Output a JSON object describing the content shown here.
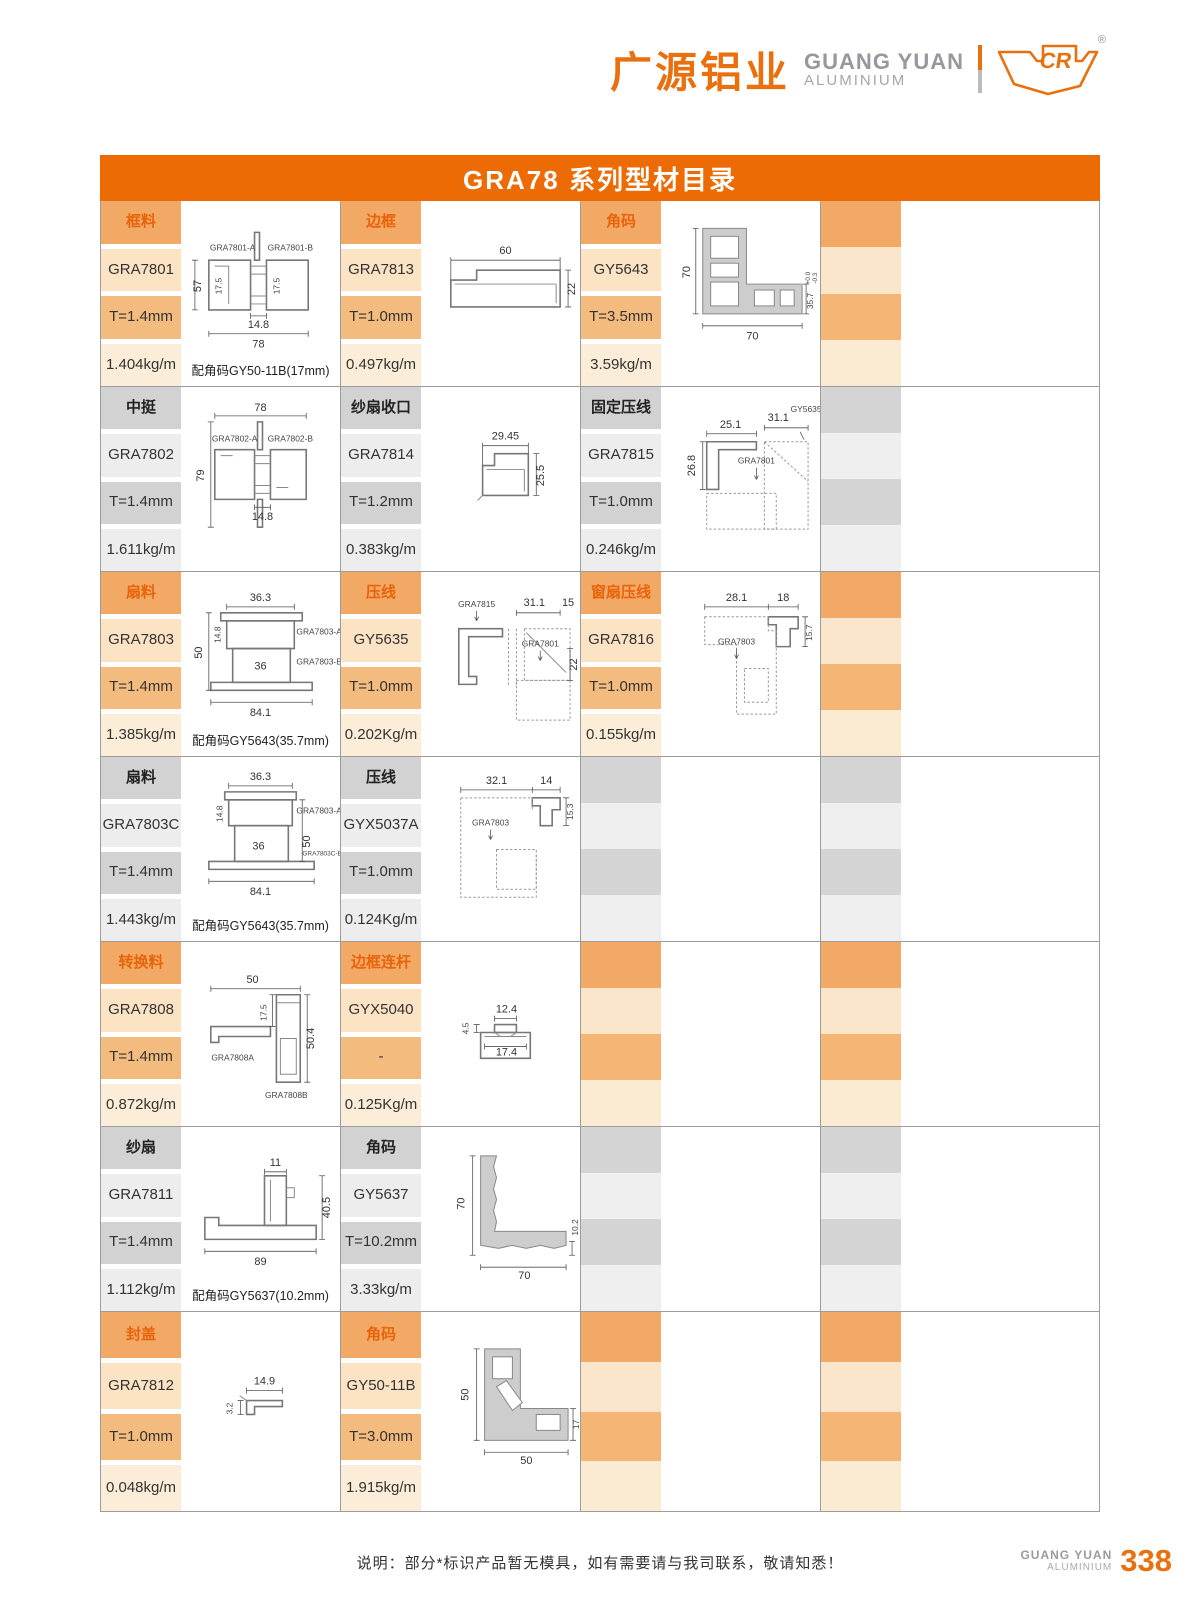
{
  "header": {
    "brand_cn": "广源铝业",
    "brand_en1": "GUANG YUAN",
    "brand_en2": "ALUMINIUM",
    "logo_mark": "CR",
    "registered": "®"
  },
  "title": "GRA78 系列型材目录",
  "colors": {
    "title_bar": "#EC6B05",
    "orange_dark": "#F2A965",
    "orange_light": "#FBE3C4",
    "orange_label_text": "#E8630A",
    "gray_dark": "#D2D2D2",
    "gray_light": "#EDEDED",
    "brand_orange": "#E8700F"
  },
  "rows": [
    {
      "tone": "orange",
      "groups": [
        {
          "label": "框料",
          "code": "GRA7801",
          "thickness": "T=1.4mm",
          "weight": "1.404kg/m",
          "note": "配角码GY50-11B(17mm)",
          "dims": [
            "57",
            "17.5",
            "17.5",
            "14.8",
            "78"
          ],
          "marks": [
            "GRA7801-A",
            "GRA7801-B"
          ]
        },
        {
          "label": "边框",
          "code": "GRA7813",
          "thickness": "T=1.0mm",
          "weight": "0.497kg/m",
          "dims": [
            "60",
            "22"
          ]
        },
        {
          "label": "角码",
          "code": "GY5643",
          "thickness": "T=3.5mm",
          "weight": "3.59kg/m",
          "dims": [
            "70",
            "70",
            "35.7",
            "+0.0",
            "-0.3"
          ]
        }
      ]
    },
    {
      "tone": "gray",
      "groups": [
        {
          "label": "中挺",
          "code": "GRA7802",
          "thickness": "T=1.4mm",
          "weight": "1.611kg/m",
          "dims": [
            "78",
            "79",
            "14.8"
          ],
          "marks": [
            "GRA7802-A",
            "GRA7802-B"
          ]
        },
        {
          "label": "纱扇收口",
          "code": "GRA7814",
          "thickness": "T=1.2mm",
          "weight": "0.383kg/m",
          "dims": [
            "29.45",
            "25.5"
          ]
        },
        {
          "label": "固定压线",
          "code": "GRA7815",
          "thickness": "T=1.0mm",
          "weight": "0.246kg/m",
          "dims": [
            "25.1",
            "26.8",
            "31.1"
          ],
          "marks": [
            "GY5635",
            "GRA7801"
          ]
        }
      ]
    },
    {
      "tone": "orange",
      "groups": [
        {
          "label": "扇料",
          "code": "GRA7803",
          "thickness": "T=1.4mm",
          "weight": "1.385kg/m",
          "note": "配角码GY5643(35.7mm)",
          "dims": [
            "36.3",
            "14.8",
            "50",
            "36",
            "84.1"
          ],
          "marks": [
            "GRA7803-A",
            "GRA7803-B"
          ]
        },
        {
          "label": "压线",
          "code": "GY5635",
          "thickness": "T=1.0mm",
          "weight": "0.202Kg/m",
          "dims": [
            "31.1",
            "15",
            "22"
          ],
          "marks": [
            "GRA7815",
            "GRA7801"
          ]
        },
        {
          "label": "窗扇压线",
          "code": "GRA7816",
          "thickness": "T=1.0mm",
          "weight": "0.155kg/m",
          "dims": [
            "28.1",
            "18",
            "15.7"
          ],
          "marks": [
            "GRA7803"
          ]
        }
      ]
    },
    {
      "tone": "gray",
      "groups": [
        {
          "label": "扇料",
          "code": "GRA7803C",
          "thickness": "T=1.4mm",
          "weight": "1.443kg/m",
          "note": "配角码GY5643(35.7mm)",
          "dims": [
            "36.3",
            "14.8",
            "50",
            "36",
            "84.1"
          ],
          "marks": [
            "GRA7803-A",
            "GRA7803C-B"
          ]
        },
        {
          "label": "压线",
          "code": "GYX5037A",
          "thickness": "T=1.0mm",
          "weight": "0.124Kg/m",
          "dims": [
            "32.1",
            "14",
            "15.3"
          ],
          "marks": [
            "GRA7803"
          ]
        }
      ]
    },
    {
      "tone": "orange",
      "groups": [
        {
          "label": "转换料",
          "code": "GRA7808",
          "thickness": "T=1.4mm",
          "weight": "0.872kg/m",
          "dims": [
            "50",
            "17.5",
            "50.4"
          ],
          "marks": [
            "GRA7808A",
            "GRA7808B"
          ]
        },
        {
          "label": "边框连杆",
          "code": "GYX5040",
          "thickness": "-",
          "weight": "0.125Kg/m",
          "dims": [
            "4.5",
            "12.4",
            "17.4"
          ]
        }
      ]
    },
    {
      "tone": "gray",
      "groups": [
        {
          "label": "纱扇",
          "code": "GRA7811",
          "thickness": "T=1.4mm",
          "weight": "1.112kg/m",
          "note": "配角码GY5637(10.2mm)",
          "dims": [
            "11",
            "40.5",
            "89"
          ]
        },
        {
          "label": "角码",
          "code": "GY5637",
          "thickness": "T=10.2mm",
          "weight": "3.33kg/m",
          "dims": [
            "70",
            "10.2",
            "70"
          ]
        }
      ]
    },
    {
      "tone": "orange",
      "groups": [
        {
          "label": "封盖",
          "code": "GRA7812",
          "thickness": "T=1.0mm",
          "weight": "0.048kg/m",
          "dims": [
            "14.9",
            "3.2"
          ]
        },
        {
          "label": "角码",
          "code": "GY50-11B",
          "thickness": "T=3.0mm",
          "weight": "1.915kg/m",
          "dims": [
            "50",
            "17",
            "50"
          ]
        }
      ]
    }
  ],
  "footer": {
    "note": "说明：部分*标识产品暂无模具，如有需要请与我司联系，敬请知悉！",
    "brand_en1": "GUANG YUAN",
    "brand_en2": "ALUMINIUM",
    "page": "338"
  }
}
